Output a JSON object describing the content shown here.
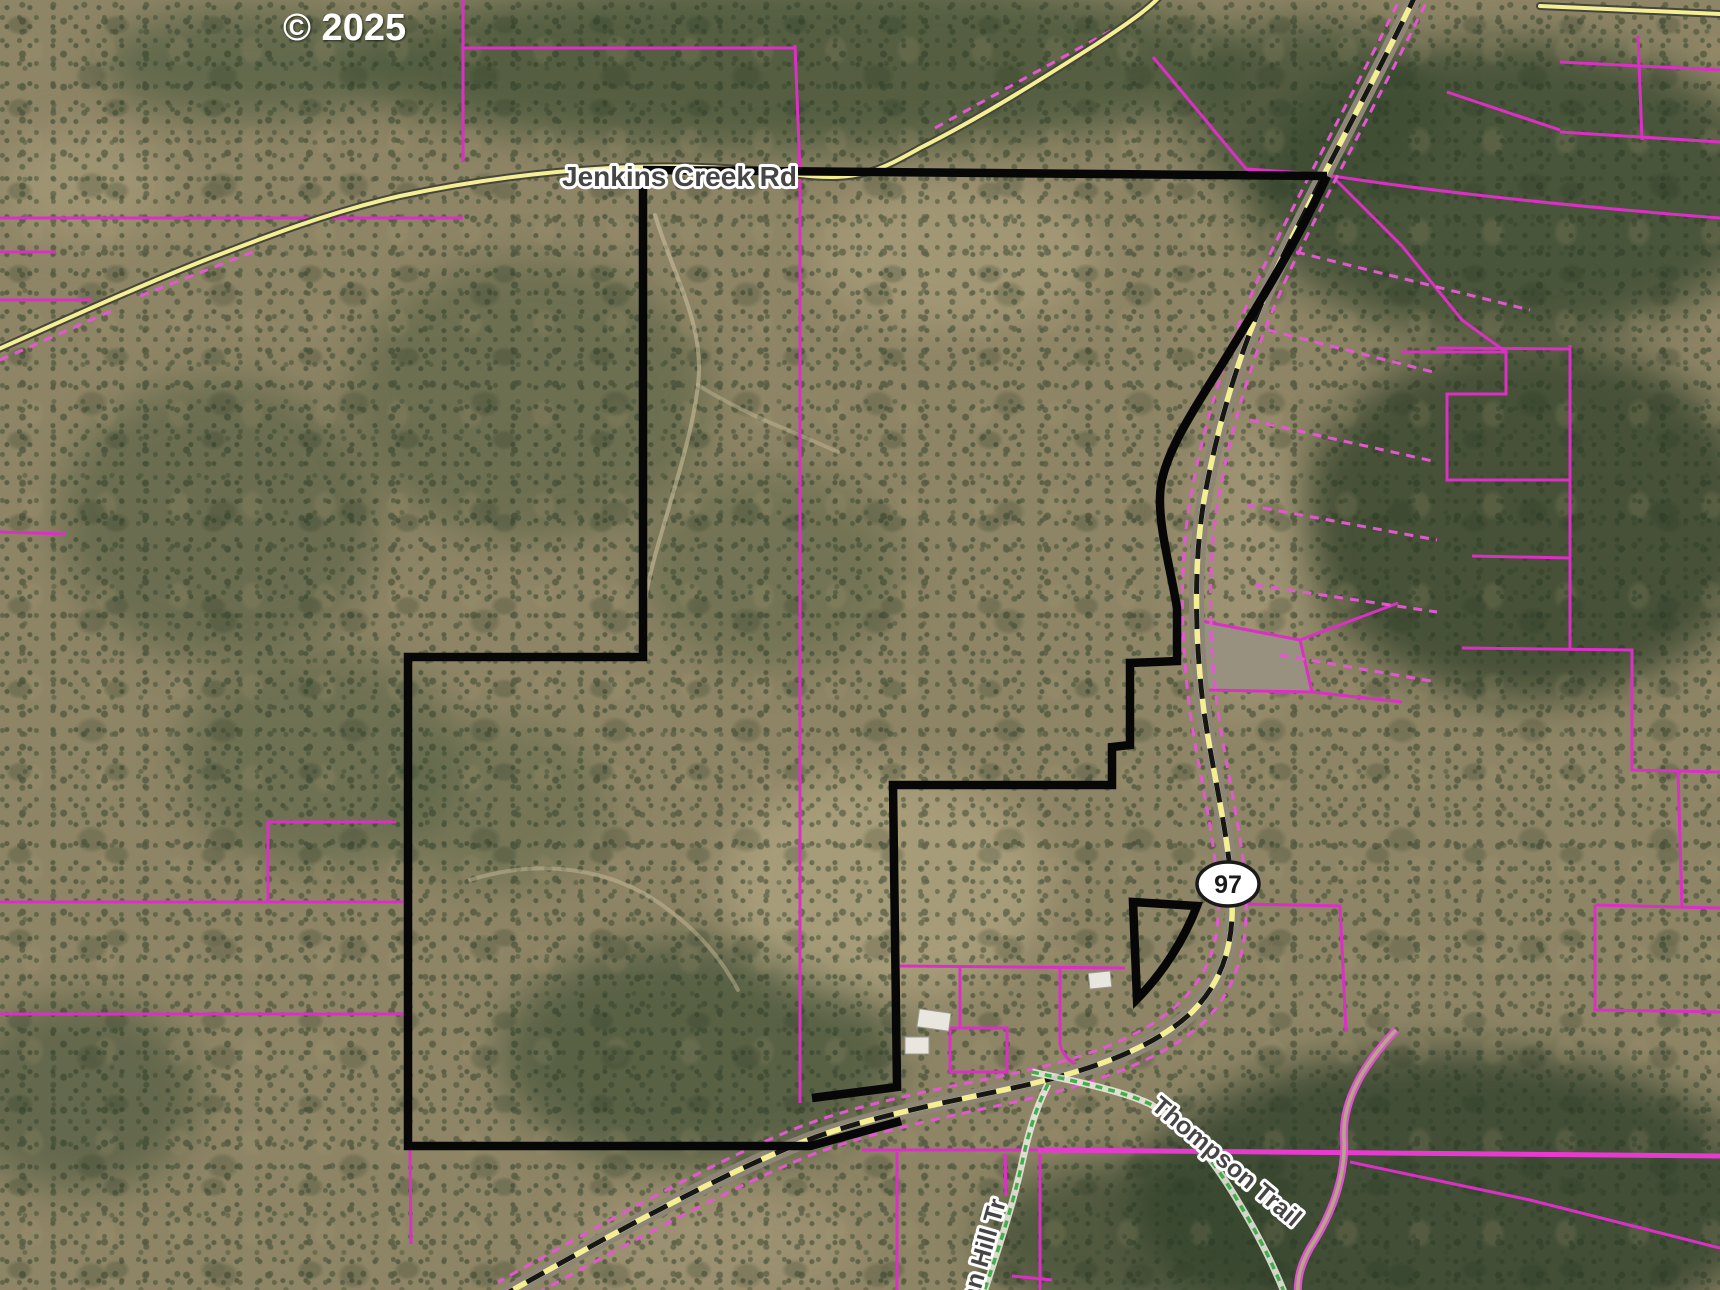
{
  "map": {
    "copyright": "© 2025",
    "roads": {
      "jenkins_creek_label": "Jenkins Creek Rd",
      "highway_shield_number": "97"
    },
    "trails": {
      "thompson_label": "Thompson Trail",
      "indian_hill_partial_label": "ian Hill Tr"
    },
    "colors": {
      "parcel_pink": "#dc2fc6",
      "parcel_pink_bright": "#e83ad0",
      "parcel_pink_dashed": "#e358d2",
      "boundary_black": "#070707",
      "road_yellow": "#f4ef92",
      "road_casing_dark": "#45453c",
      "highway_casing_gray": "#8d8576",
      "trail_green": "#3faf4c",
      "shield_fill": "#ffffff"
    }
  }
}
